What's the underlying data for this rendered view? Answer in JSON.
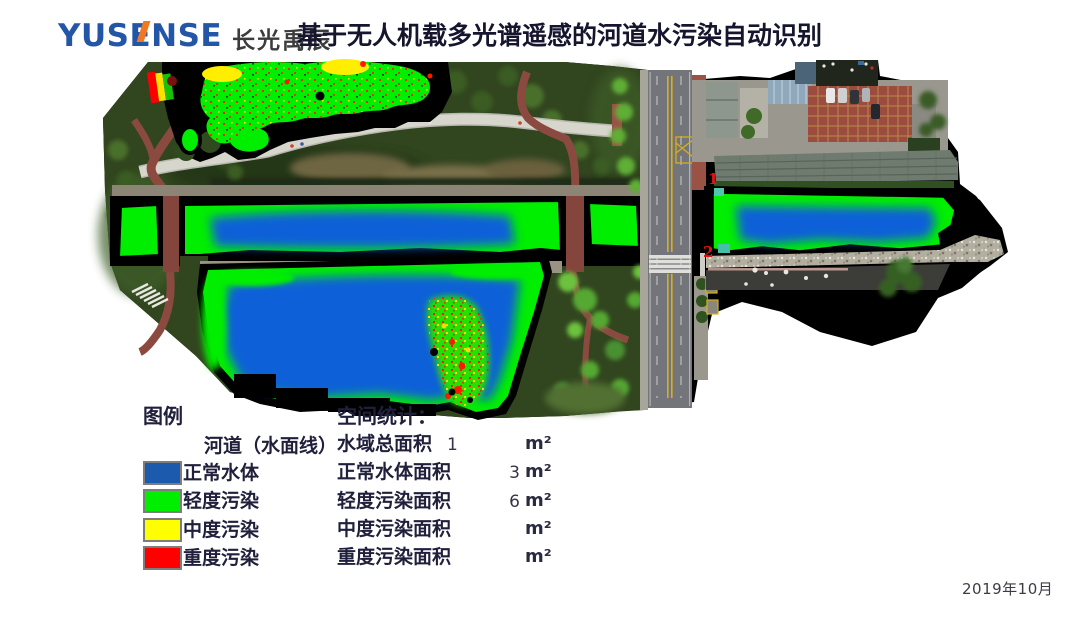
{
  "brand": {
    "name": "YUSENSE",
    "name_cn": "长光禹辰"
  },
  "title": "基于无人机载多光谱遥感的河道水污染自动识别",
  "map": {
    "point_labels": [
      "1",
      "2"
    ]
  },
  "legend": {
    "title": "图例",
    "river_line_label": "河道（水面线）",
    "classes": [
      {
        "label": "正常水体",
        "color": "#1b5aad"
      },
      {
        "label": "轻度污染",
        "color": "#00ee00"
      },
      {
        "label": "中度污染",
        "color": "#ffff00"
      },
      {
        "label": "重度污染",
        "color": "#ff0000"
      }
    ]
  },
  "stats": {
    "title": "空间统计：",
    "unit": "m²",
    "rows": [
      {
        "label": "水域总面积",
        "value": "1"
      },
      {
        "label": "正常水体面积",
        "value": "3"
      },
      {
        "label": "轻度污染面积",
        "value": "6"
      },
      {
        "label": "中度污染面积",
        "value": ""
      },
      {
        "label": "重度污染面积",
        "value": ""
      }
    ]
  },
  "date": "2019年10月",
  "colors": {
    "normal_water": "#1b5aad",
    "light_pollution": "#00ee00",
    "medium_pollution": "#ffff00",
    "heavy_pollution": "#ff0000",
    "water_line": "#000000"
  }
}
